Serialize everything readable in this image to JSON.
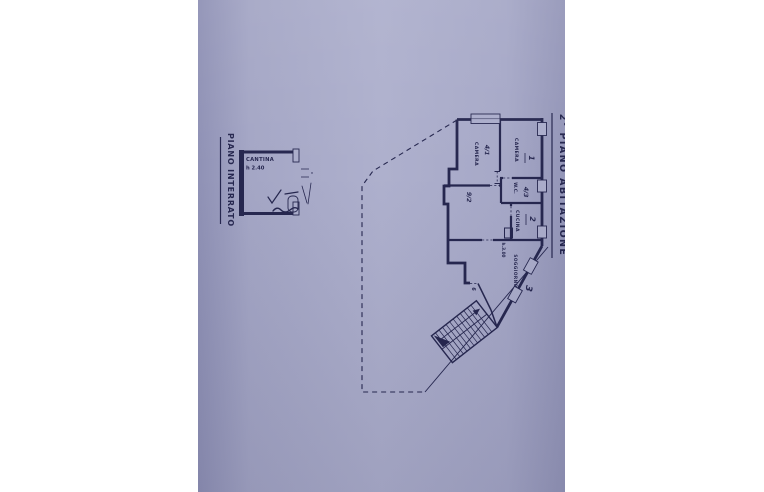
{
  "plan": {
    "titles": {
      "floor_below": "PIANO INTERRATO",
      "floor_main": "2° PIANO ABITAZIONE"
    },
    "cantina": {
      "name": "CANTINA",
      "height": "h 2.40"
    },
    "rooms": {
      "camera1": {
        "name": "CAMERA",
        "code": "4/1"
      },
      "camera2": {
        "name": "CAMERA",
        "unit": "1"
      },
      "wc": {
        "name": "W.C.",
        "code": "4/3"
      },
      "cucina": {
        "name": "CUCINA",
        "unit": "2"
      },
      "disimpegno": {
        "code": "9/2"
      },
      "soggiorno": {
        "name": "SOGGIORNO",
        "unit": "3",
        "height": "h.3.00"
      },
      "ingresso": {
        "code": "6"
      }
    },
    "colors": {
      "paper": "#a8aac8",
      "ink": "#26274f",
      "page_background": "#ffffff"
    }
  }
}
